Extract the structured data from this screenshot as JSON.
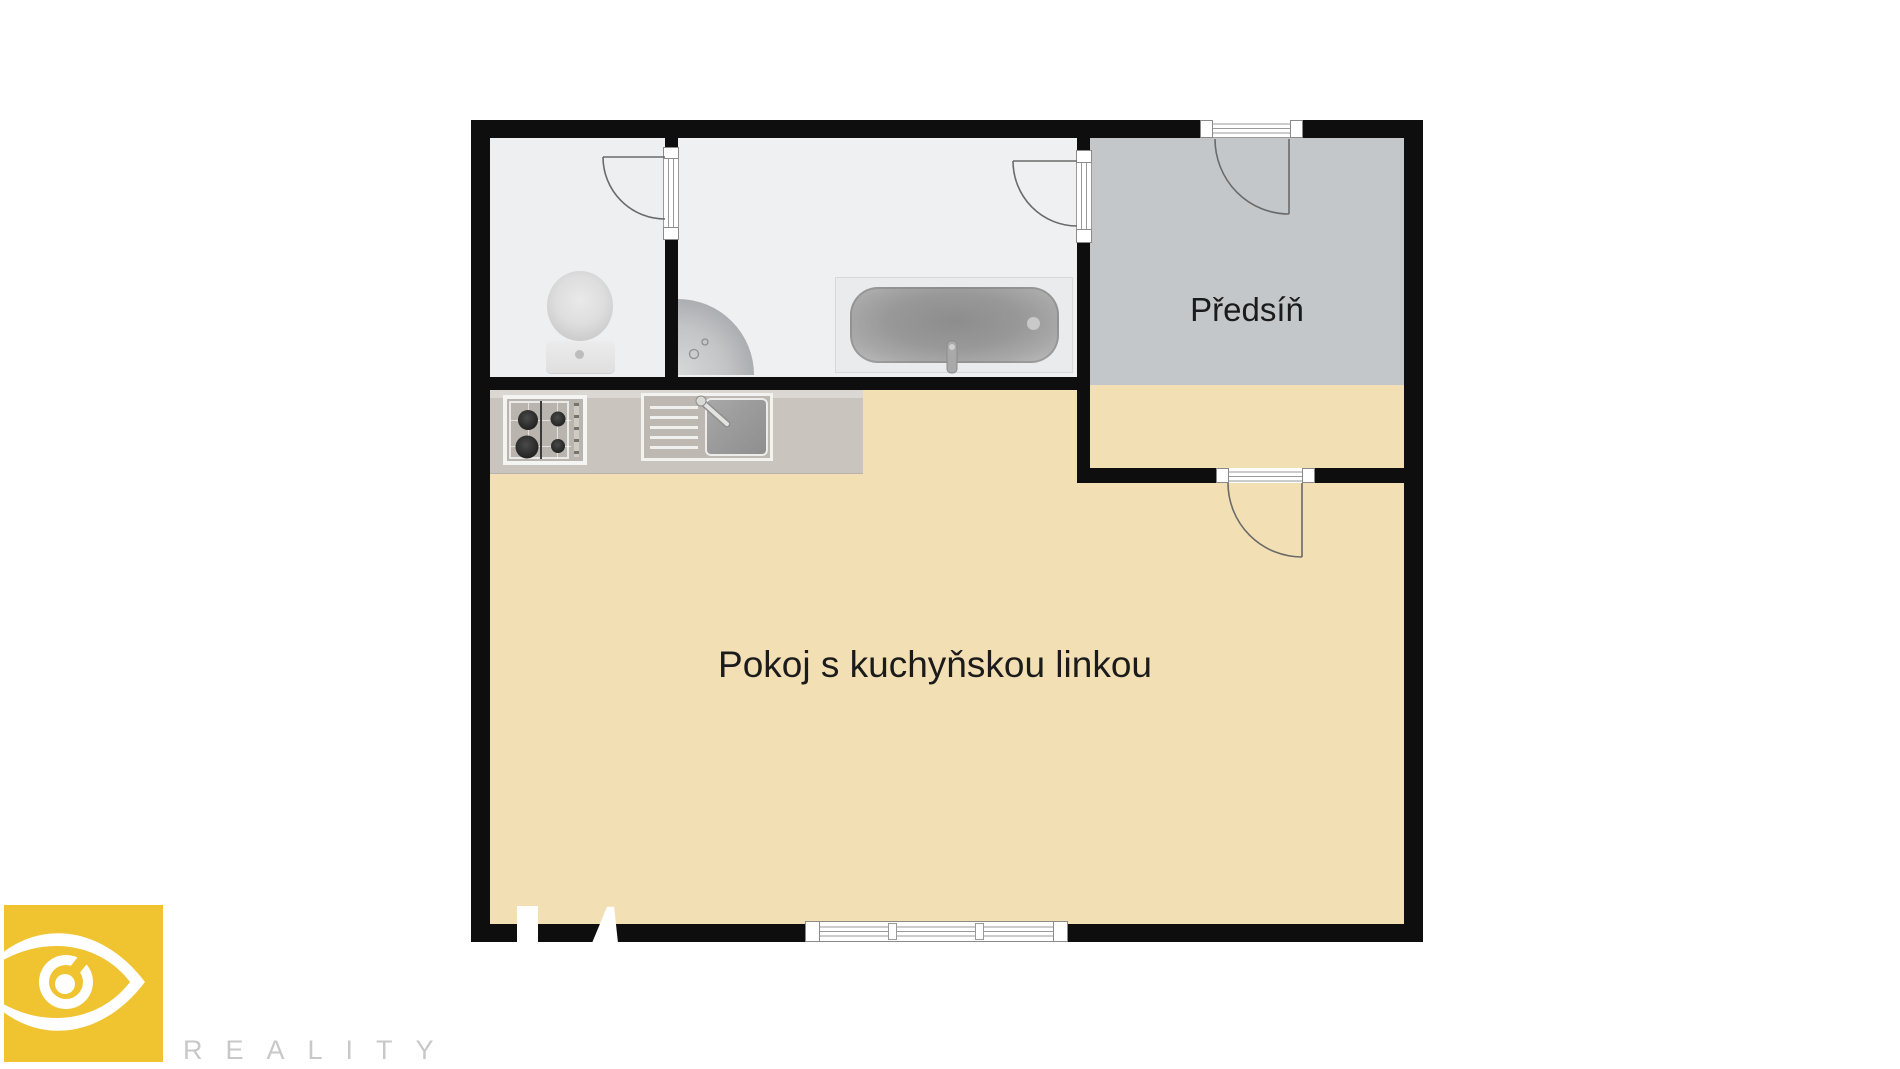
{
  "canvas": {
    "width": 1900,
    "height": 1069,
    "background": "#ffffff"
  },
  "floorplan": {
    "wall_color": "#0e0e0e",
    "label_color": "#1b1b1b",
    "rooms": [
      {
        "id": "wc",
        "label": "",
        "floor_color": "#edeff0"
      },
      {
        "id": "bathroom",
        "label": "",
        "floor_color": "#eef0f1"
      },
      {
        "id": "hallway",
        "label": "Předsíň",
        "floor_color": "#c4c7ca"
      },
      {
        "id": "living-kitchen",
        "label": "Pokoj s kuchyňskou linkou",
        "floor_color": "#f3dfb4"
      }
    ],
    "doors": [
      "entrance-door",
      "bathroom-door",
      "wc-door",
      "hallway-living-door"
    ],
    "fixtures": [
      "kitchen-counter",
      "stove",
      "kitchen-sink",
      "toilet",
      "corner-washbasin",
      "bathtub",
      "window"
    ]
  },
  "branding": {
    "wordmark": "REALITY",
    "wordmark_color": "#c8c8c8",
    "logo_icon": "eye-icon",
    "logo_color": "#f0c330"
  }
}
